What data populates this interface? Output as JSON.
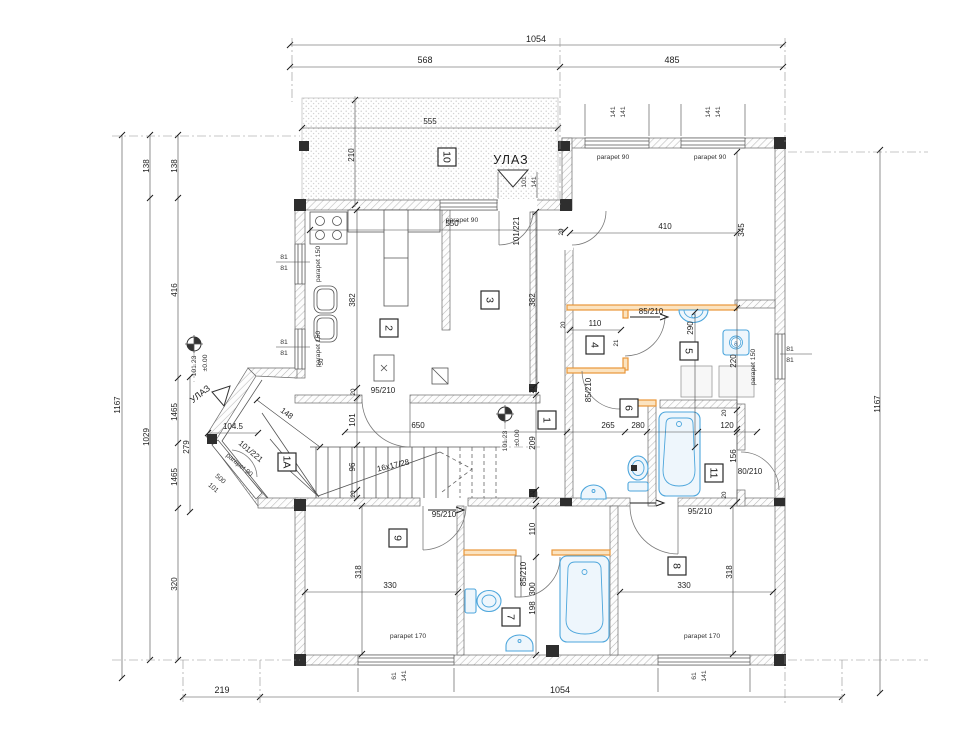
{
  "colors": {
    "line": "#3a3a3a",
    "dimension": "#474747",
    "wall_orange": "#e8973a",
    "fixture_blue": "#4da6dc",
    "hatch_gray": "#b9b9b9"
  },
  "texts": {
    "entrance": "УЛАЗ",
    "stairs": "16x17/28",
    "level_rel": "±0.00",
    "level_abs": "101.23",
    "parapet90": "parapet  90",
    "parapet150": "parapet  150",
    "parapet170": "parapet  170",
    "d1054": "1054",
    "d568": "568",
    "d485": "485",
    "d555": "555",
    "d210": "210",
    "d410": "410",
    "d345": "345",
    "d550": "550",
    "d382": "382",
    "d650": "650",
    "d209": "209",
    "d110": "110",
    "d21": "21",
    "d290": "290",
    "d220": "220",
    "d265": "265",
    "d280": "280",
    "d120": "120",
    "d156": "156",
    "d330": "330",
    "d318": "318",
    "d300": "300",
    "d198": "198",
    "d320": "320",
    "d416": "416",
    "d138": "138",
    "d1029": "1029",
    "d1167": "1167",
    "d1465": "1465",
    "d104_5": "104.5",
    "d148": "148",
    "d279": "279",
    "d219": "219",
    "d500": "500",
    "d101": "101",
    "d96": "96",
    "d50": "50",
    "d20": "20",
    "d141": "141",
    "d61": "61",
    "d81": "81",
    "door101_221": "101/221",
    "door95_210": "95/210",
    "door85_210": "85/210",
    "door80_210": "80/210",
    "ann_a": "a"
  },
  "rooms": {
    "r1": "1",
    "r1a": "1A",
    "r2": "2",
    "r3": "3",
    "r4": "4",
    "r5": "5",
    "r6": "6",
    "r7": "7",
    "r8": "8",
    "r9": "9",
    "r10": "10",
    "r11": "11"
  }
}
